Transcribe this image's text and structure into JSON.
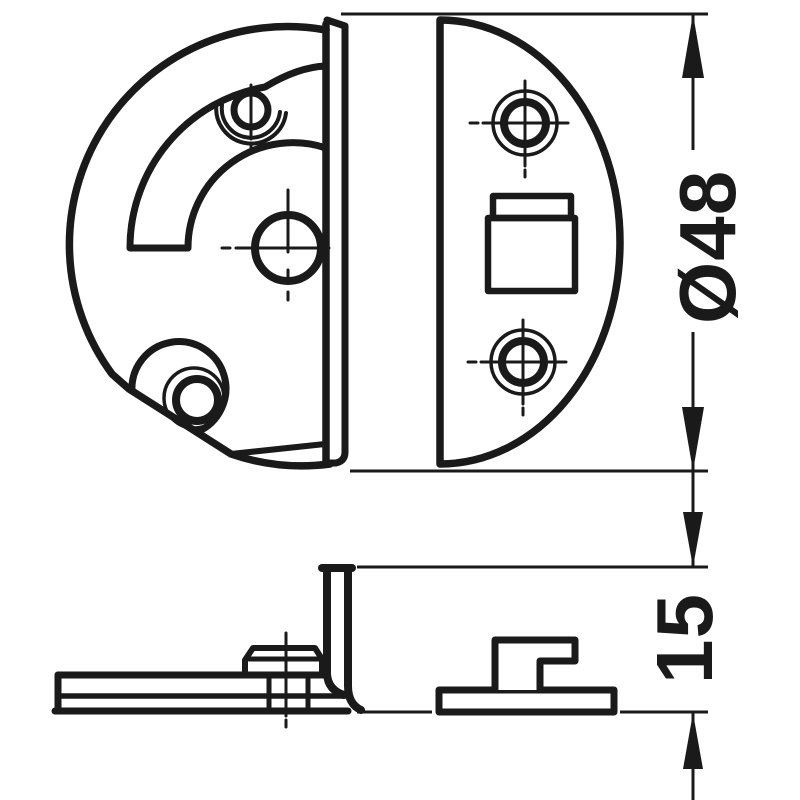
{
  "page": {
    "background_color": "#ffffff",
    "line_color": "#1a1a1a",
    "description": "Technical drawing of circular furniture fitting: front views of housing and cover plate, side views, with dimensions"
  },
  "dimensions": {
    "diameter_label": "Ø48",
    "height_label": "15"
  }
}
